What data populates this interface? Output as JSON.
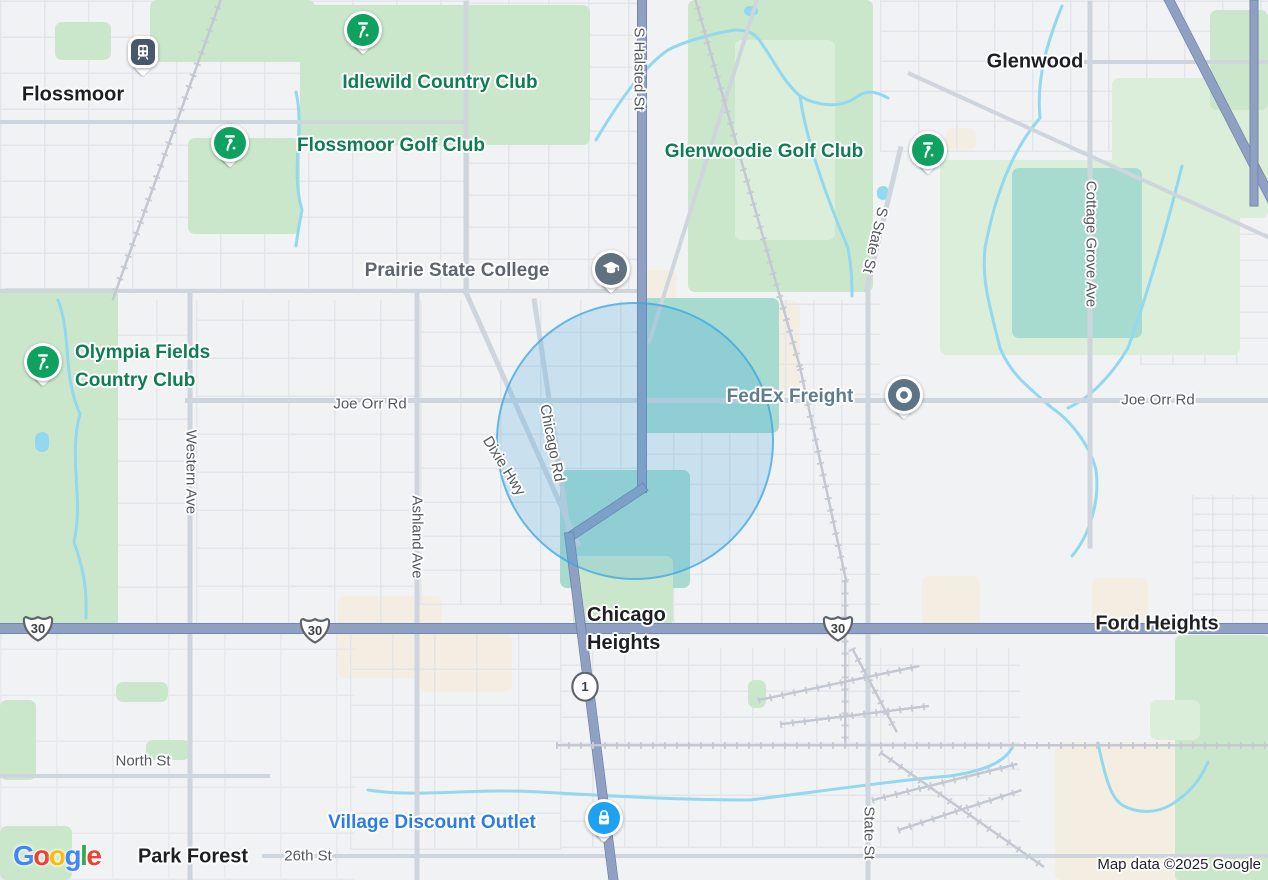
{
  "ui": {
    "logo_text": "Google",
    "logo_letters": [
      {
        "ch": "G",
        "color": "#4285F4"
      },
      {
        "ch": "o",
        "color": "#EA4335"
      },
      {
        "ch": "o",
        "color": "#FBBC05"
      },
      {
        "ch": "g",
        "color": "#4285F4"
      },
      {
        "ch": "l",
        "color": "#34A853"
      },
      {
        "ch": "e",
        "color": "#EA4335"
      }
    ],
    "attribution": "Map data ©2025 Google"
  },
  "cities": [
    {
      "id": "flossmoor",
      "name": "Flossmoor",
      "x": 73,
      "y": 95
    },
    {
      "id": "glenwood",
      "name": "Glenwood",
      "x": 1035,
      "y": 62
    },
    {
      "id": "park-forest",
      "name": "Park Forest",
      "x": 193,
      "y": 857
    },
    {
      "id": "ford-heights",
      "name": "Ford Heights",
      "x": 1157,
      "y": 624
    },
    {
      "id": "chicago-heights",
      "name": "Chicago Heights",
      "lines": [
        "Chicago",
        "Heights"
      ],
      "lx": 587,
      "ly": 601
    }
  ],
  "streets": [
    {
      "id": "joe-orr-rd-w",
      "name": "Joe Orr Rd",
      "x": 370,
      "y": 404,
      "rot": 0
    },
    {
      "id": "joe-orr-rd-e",
      "name": "Joe Orr Rd",
      "x": 1158,
      "y": 400,
      "rot": 0
    },
    {
      "id": "north-st",
      "name": "North St",
      "x": 143,
      "y": 761,
      "rot": 0
    },
    {
      "id": "26th-st",
      "name": "26th St",
      "x": 308,
      "y": 856,
      "rot": 0
    },
    {
      "id": "western-ave",
      "name": "Western Ave",
      "x": 191,
      "y": 472,
      "rot": 90
    },
    {
      "id": "ashland-ave",
      "name": "Ashland Ave",
      "x": 417,
      "y": 537,
      "rot": 90
    },
    {
      "id": "state-st",
      "name": "State St",
      "x": 869,
      "y": 833,
      "rot": 90
    },
    {
      "id": "s-state-st",
      "name": "S State St",
      "x": 875,
      "y": 240,
      "rot": 103
    },
    {
      "id": "cottage-grove-ave",
      "name": "Cottage Grove Ave",
      "x": 1091,
      "y": 244,
      "rot": 90
    },
    {
      "id": "s-halsted-st",
      "name": "S Halsted St",
      "x": 639,
      "y": 69,
      "rot": 90
    },
    {
      "id": "chicago-rd",
      "name": "Chicago Rd",
      "x": 552,
      "y": 443,
      "rot": 79
    },
    {
      "id": "dixie-hwy",
      "name": "Dixie Hwy",
      "x": 504,
      "y": 466,
      "rot": 58
    }
  ],
  "pois": [
    {
      "id": "idlewild-country-club",
      "name": "Idlewild Country Club",
      "icon": "golf-flag-icon",
      "label_x": 440,
      "label_y": 83,
      "pin_x": 363,
      "pin_y": 30,
      "type": "golf",
      "label_color": "#0e7d52"
    },
    {
      "id": "flossmoor-golf-club",
      "name": "Flossmoor Golf Club",
      "icon": "golf-flag-icon",
      "label_x": 391,
      "label_y": 146,
      "pin_x": 230,
      "pin_y": 143,
      "type": "golf",
      "label_color": "#0e7d52"
    },
    {
      "id": "glenwoodie-golf-club",
      "name": "Glenwoodie Golf Club",
      "icon": "golf-flag-icon",
      "label_x": 764,
      "label_y": 152,
      "pin_x": 928,
      "pin_y": 150,
      "type": "golf",
      "label_color": "#0e7d52"
    },
    {
      "id": "olympia-fields-country-club",
      "name": "Olympia Fields Country Club",
      "icon": "golf-flag-icon",
      "lines": [
        "Olympia Fields",
        "Country Club"
      ],
      "lx": 75,
      "ly": 339,
      "pin_x": 43,
      "pin_y": 362,
      "type": "golf",
      "label_color": "#0e7d52"
    },
    {
      "id": "prairie-state-college",
      "name": "Prairie State College",
      "icon": "graduation-cap-icon",
      "label_x": 457,
      "label_y": 271,
      "pin_x": 611,
      "pin_y": 269,
      "type": "school",
      "label_color": "#5d666f"
    },
    {
      "id": "fedex-freight",
      "name": "FedEx Freight",
      "icon": "business-dot-icon",
      "label_x": 790,
      "label_y": 397,
      "pin_x": 904,
      "pin_y": 395,
      "type": "business",
      "label_color": "#5f7d8f"
    },
    {
      "id": "village-discount-outlet",
      "name": "Village Discount Outlet",
      "icon": "shopping-bag-icon",
      "label_x": 432,
      "label_y": 823,
      "pin_x": 604,
      "pin_y": 818,
      "type": "shopping",
      "label_color": "#2b7ce9"
    },
    {
      "id": "flossmoor-station",
      "name": "",
      "icon": "train-station-icon",
      "pin_x": 143,
      "pin_y": 52,
      "type": "train",
      "label_color": ""
    }
  ],
  "shields": [
    {
      "id": "us-30-west",
      "route": "30",
      "kind": "us",
      "x": 38,
      "y": 628
    },
    {
      "id": "us-30-mid",
      "route": "30",
      "kind": "us",
      "x": 315,
      "y": 630
    },
    {
      "id": "us-30-east",
      "route": "30",
      "kind": "us",
      "x": 838,
      "y": 628
    },
    {
      "id": "il-1",
      "route": "1",
      "kind": "circle",
      "x": 585,
      "y": 688
    }
  ],
  "highlight_circle": {
    "cx": 635,
    "cy": 441,
    "r": 139
  },
  "colors": {
    "map_background": "#f1f2f4",
    "park_green": "#cbe7cb",
    "park_green_light": "#daeeda",
    "teal_area": "#a7dbd0",
    "commercial_beige": "#f3eee1",
    "water_blue": "#92d8ee",
    "highway_fill": "#8fa0c3",
    "highway_casing": "#7486ad",
    "road_gray": "#cfd5dd",
    "railroad": "#c9cdd6",
    "circle_stroke": "#3aa5e1",
    "golf_pin": "#0ea15f",
    "school_pin": "#5f707e",
    "business_pin": "#5c7486",
    "shopping_pin": "#1ea1f2",
    "train_pin": "#47586a",
    "city_label": "#1d1f23",
    "street_label": "#54585f"
  }
}
